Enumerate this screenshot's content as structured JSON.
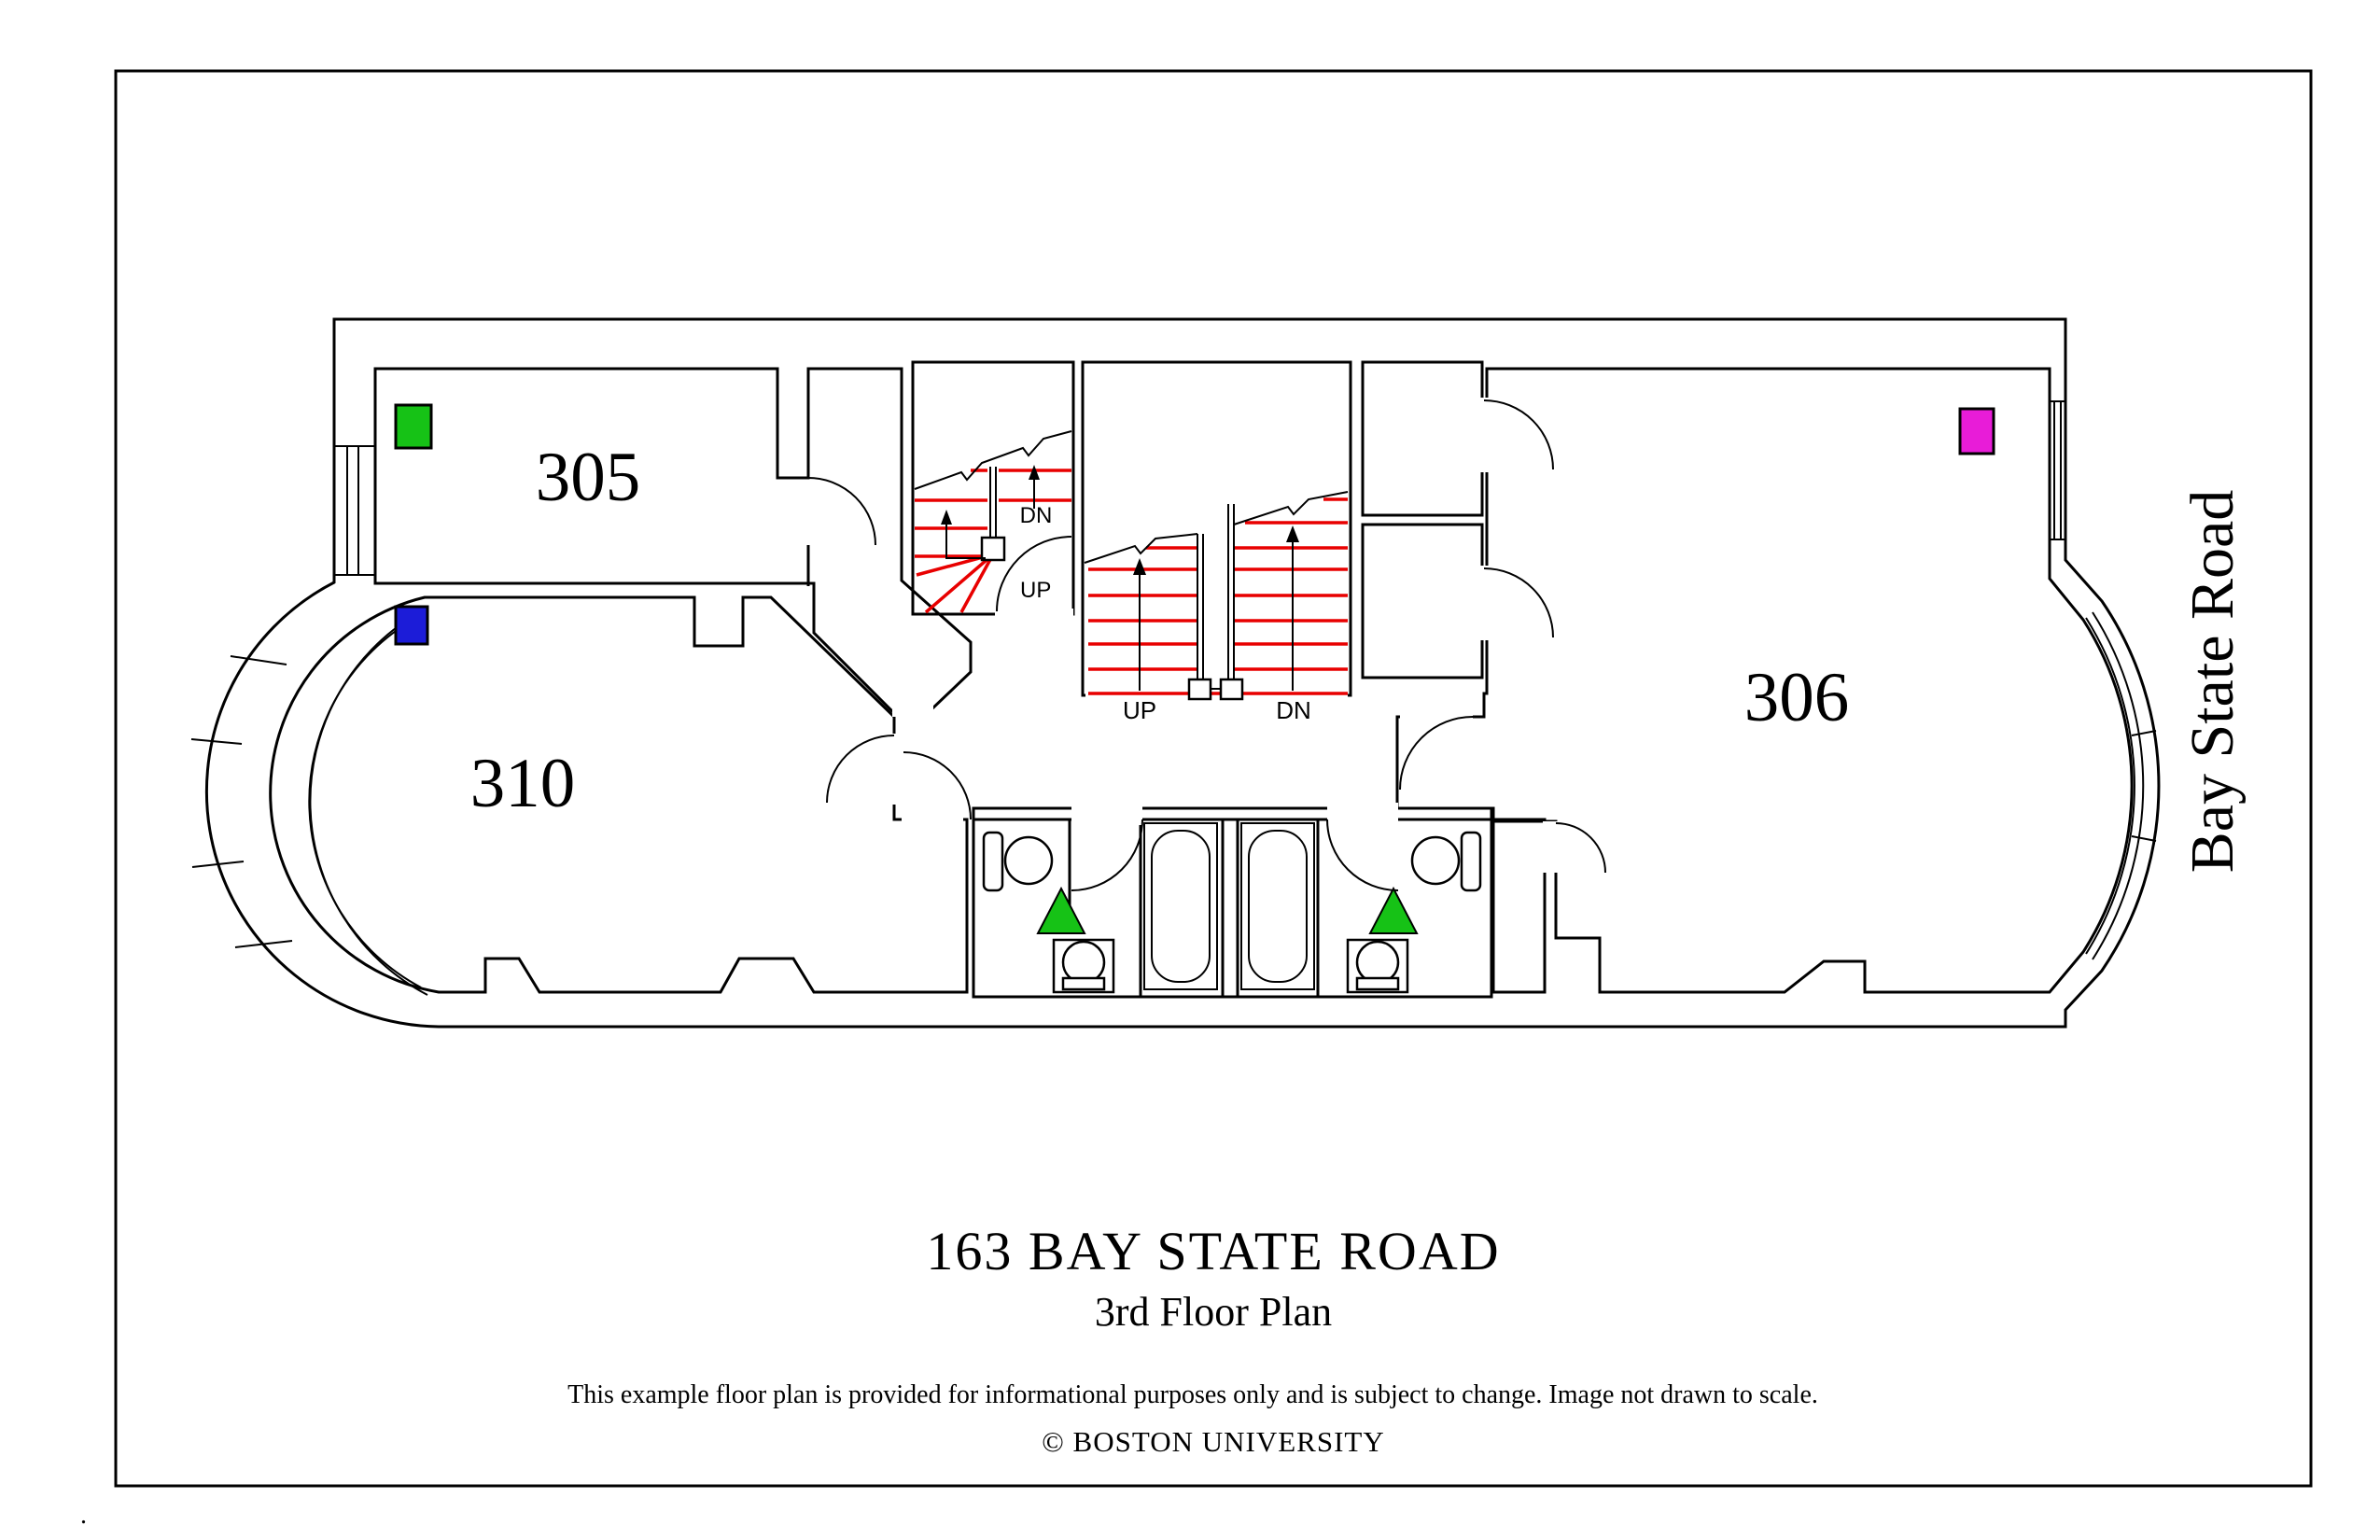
{
  "plan": {
    "title": "163 BAY STATE ROAD",
    "subtitle": "3rd Floor Plan",
    "disclaimer": "This example floor plan is provided for informational purposes only and is subject to change. Image not drawn to scale.",
    "copyright": "© BOSTON UNIVERSITY",
    "street_label": "Bay State Road",
    "stray_mark": "."
  },
  "rooms": {
    "r305": {
      "number": "305",
      "fill": "#B3FCFC",
      "marker": "green-square",
      "marker_color": "#16C216"
    },
    "r310": {
      "number": "310",
      "fill": "#FCFCB4",
      "marker": "blue-square",
      "marker_color": "#1C1CD8"
    },
    "r306": {
      "number": "306",
      "fill": "#B3FCFC",
      "marker": "magenta-square",
      "marker_color": "#E81CD8"
    }
  },
  "stairs": {
    "up_label": "UP",
    "dn_label": "DN",
    "tread_color": "#E80000"
  },
  "markers": {
    "bathroom_triangle_color": "#16C216"
  },
  "colors": {
    "wall": "#000000",
    "background": "#FFFFFF",
    "cyan_room": "#B3FCFC",
    "yellow_room": "#FCFCB4"
  }
}
